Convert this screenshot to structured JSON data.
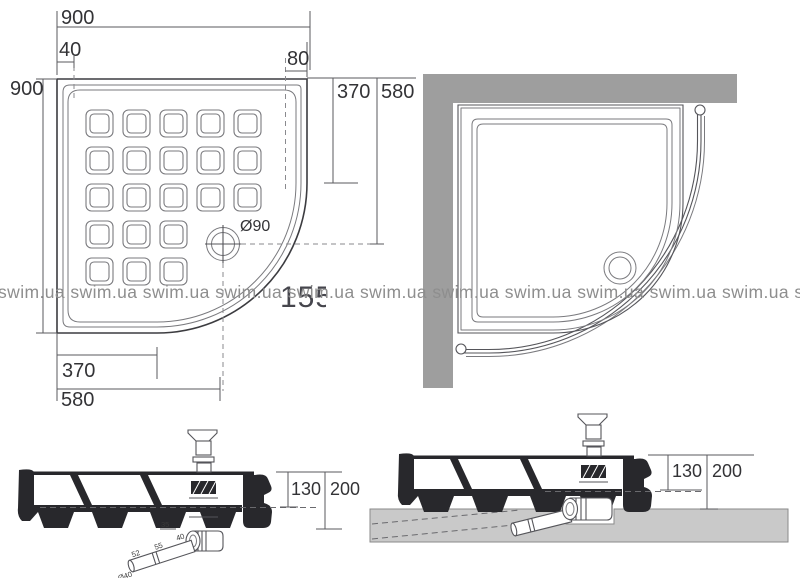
{
  "plan_left": {
    "top_width": "900",
    "left_height": "900",
    "rim_offset": "40",
    "edge_offset": "80",
    "right_to_arc": "370",
    "right_to_drain": "580",
    "drain_diameter": "Ø90",
    "bottom_to_arc": "370",
    "bottom_to_drain": "580"
  },
  "section_left": {
    "tray_depth": "130",
    "total_height": "200",
    "trap_dim_a": "52",
    "trap_dim_b": "55",
    "trap_dim_c": "35",
    "trap_dim_d": "40",
    "trap_outlet": "Ø40"
  },
  "section_right": {
    "tray_depth": "130",
    "total_height": "200"
  },
  "watermark": {
    "text": "swim.ua"
  },
  "model_label": {
    "text": "155"
  },
  "colors": {
    "wall": "#9e9e9e",
    "floor": "#c9c9c9",
    "tray_section_fill": "#28282c",
    "line": "#4a4a4e",
    "watermark": "#8e8e8e"
  }
}
